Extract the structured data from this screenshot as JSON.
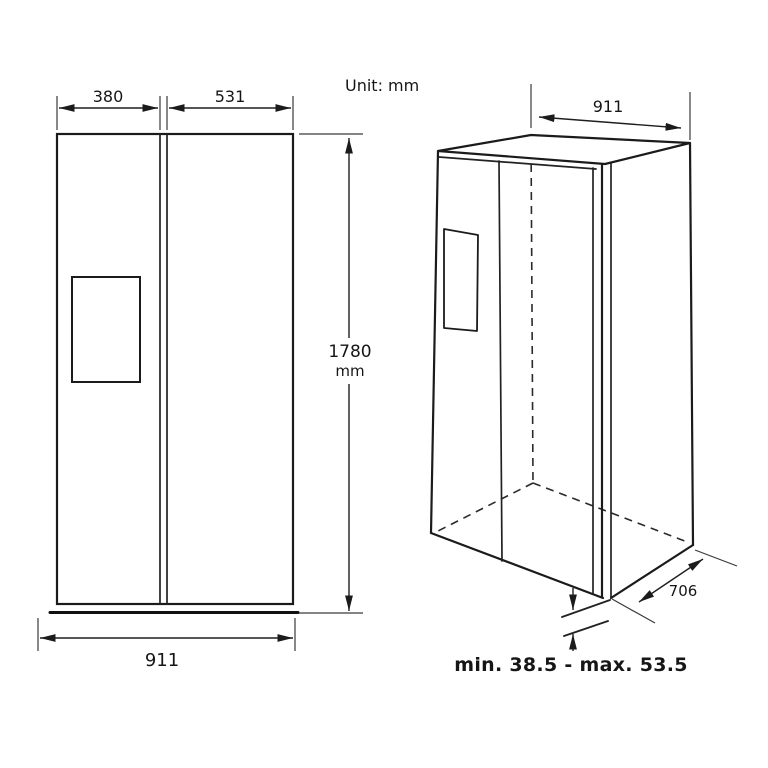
{
  "unit_note": "Unit: mm",
  "front_view": {
    "left_door_width": "380",
    "right_door_width": "531",
    "height": "1780",
    "height_unit": "mm",
    "overall_width": "911"
  },
  "perspective_view": {
    "overall_width": "911",
    "depth": "706",
    "feet_height_range": "min. 38.5 - max. 53.5"
  }
}
